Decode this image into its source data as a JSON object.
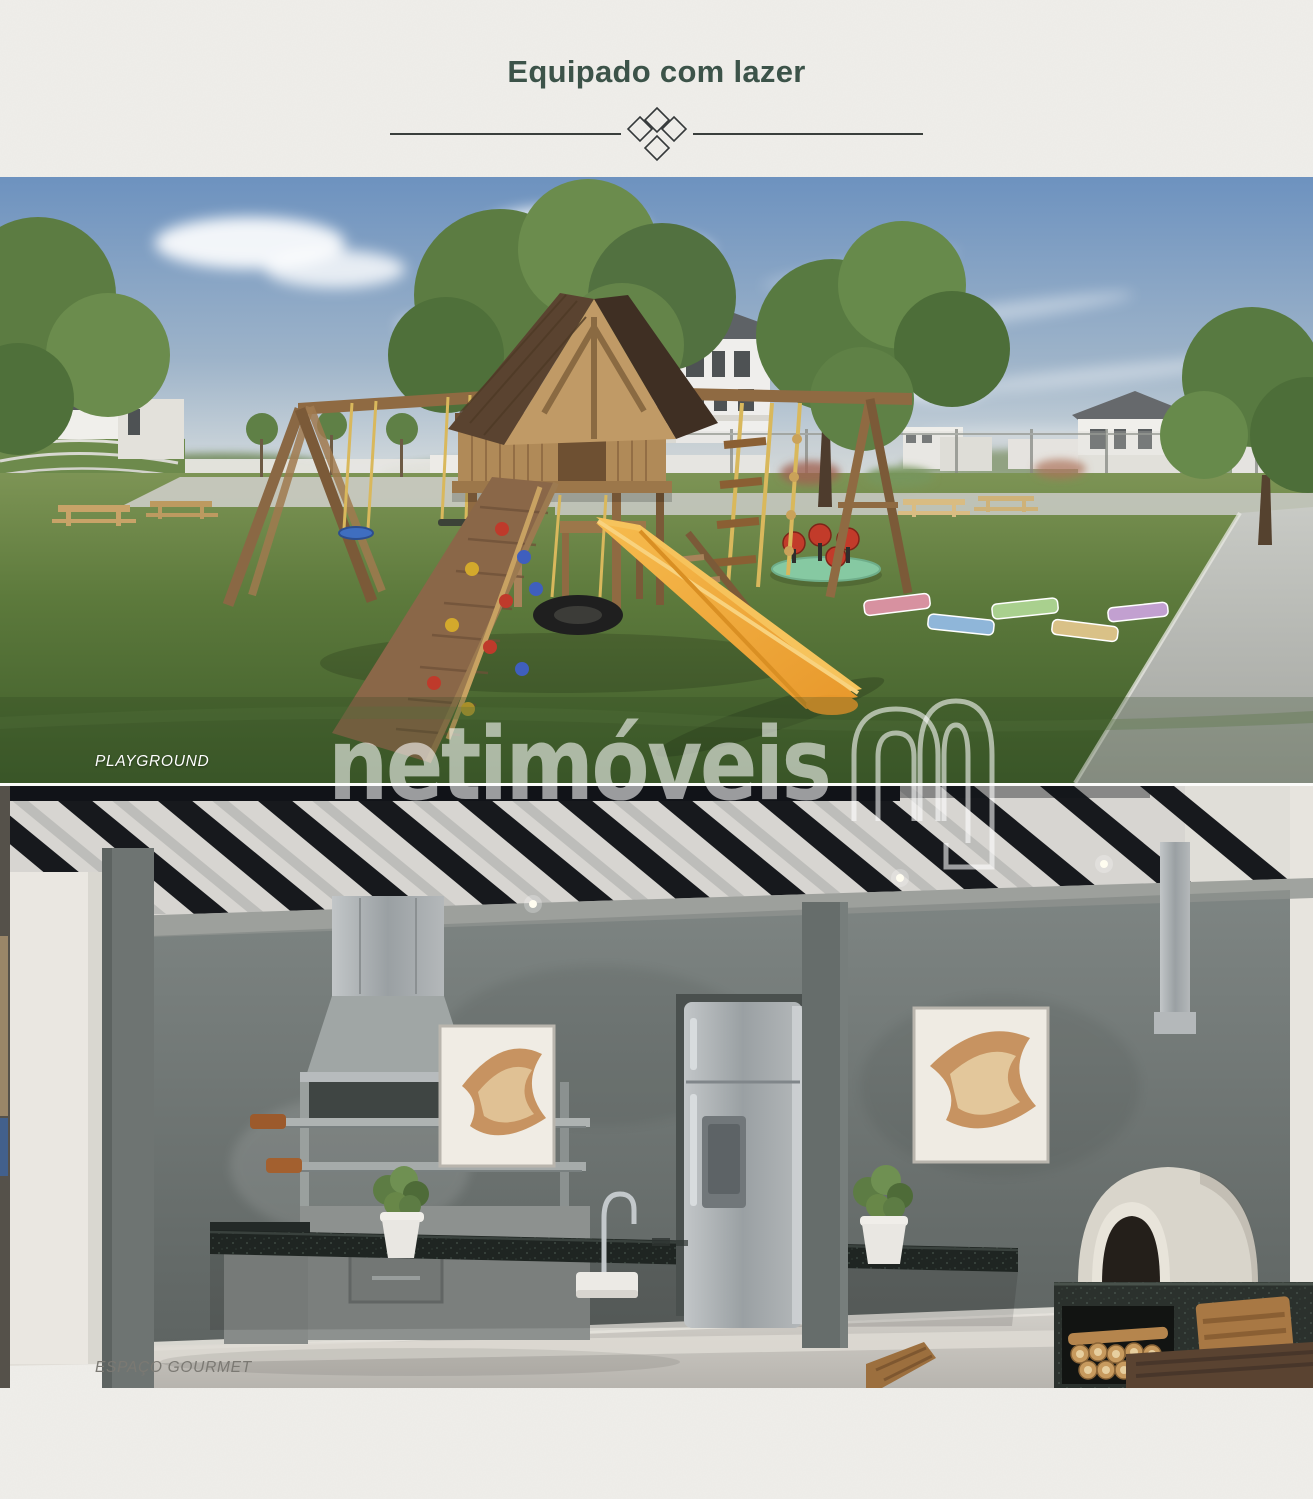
{
  "page": {
    "title": "Equipado com lazer",
    "background": "#efeeea",
    "title_color": "#3c5349"
  },
  "divider": {
    "type": "line-with-diamond-knot-ornament",
    "color": "#3a3f3c"
  },
  "figures": [
    {
      "id": "playground",
      "caption": "PLAYGROUND",
      "caption_color": "#ffffff"
    },
    {
      "id": "espaco-gourmet",
      "caption": "ESPAÇO GOURMET",
      "caption_color": "#7b7973"
    }
  ],
  "watermark": {
    "text": "netimóveis",
    "logo_icon": "netimoveis-n-outline-logo",
    "color": "#ffffff",
    "opacity": 0.58
  },
  "palette": {
    "sky": "#6d92bf",
    "grass_light": "#7d9455",
    "grass_dark": "#42602c",
    "slide_yellow": "#f0a73a",
    "wood": "#8f6a42",
    "roof_shingle": "#5a4330",
    "pergola_black": "#17191d",
    "concrete_wall": "#6e7573",
    "granite": "#1f2522",
    "oven_dome": "#d9d5cb",
    "floor": "#c9c6c0"
  }
}
